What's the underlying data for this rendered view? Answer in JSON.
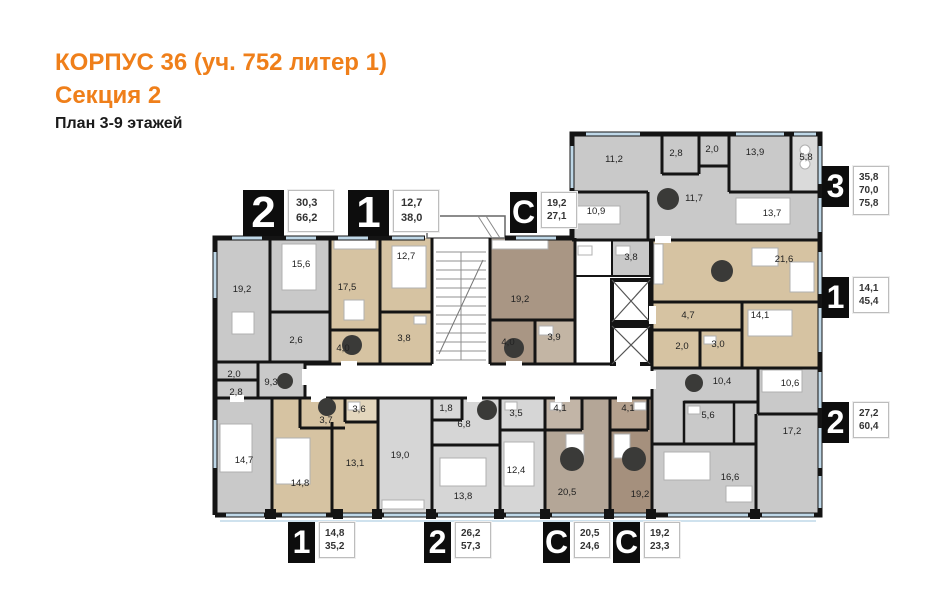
{
  "header": {
    "building_title": "КОРПУС 36 (уч. 752 литер 1)",
    "section_title": "Секция 2",
    "floors_subtitle": "План 3-9 этажей"
  },
  "colors": {
    "accent": "#ef7f1a",
    "wall": "#141414",
    "apartment_gray": "#c9c9c9",
    "apartment_gray_light": "#d6d6d6",
    "apartment_tan": "#d6c3a2",
    "studio_top_brown": "#a99684",
    "studio_light_brown": "#b4a697",
    "studio_dark_brown": "#a5907d",
    "window_glazing": "#bfd8e8",
    "entry_marker": "#3a3a38"
  },
  "plan": {
    "apartment_tags": [
      {
        "number": "2",
        "values": [
          "30,3",
          "66,2"
        ],
        "x": 243,
        "y": 190,
        "size": "large"
      },
      {
        "number": "1",
        "values": [
          "12,7",
          "38,0"
        ],
        "x": 348,
        "y": 190,
        "size": "large"
      },
      {
        "number": "С",
        "values": [
          "19,2",
          "27,1"
        ],
        "x": 510,
        "y": 192,
        "size": "small"
      },
      {
        "number": "3",
        "values": [
          "35,8",
          "70,0",
          "75,8"
        ],
        "x": 822,
        "y": 166,
        "size": "small"
      },
      {
        "number": "1",
        "values": [
          "14,1",
          "45,4"
        ],
        "x": 822,
        "y": 277,
        "size": "small"
      },
      {
        "number": "2",
        "values": [
          "27,2",
          "60,4"
        ],
        "x": 822,
        "y": 402,
        "size": "small"
      },
      {
        "number": "1",
        "values": [
          "14,8",
          "35,2"
        ],
        "x": 288,
        "y": 522,
        "size": "small"
      },
      {
        "number": "2",
        "values": [
          "26,2",
          "57,3"
        ],
        "x": 424,
        "y": 522,
        "size": "small"
      },
      {
        "number": "С",
        "values": [
          "20,5",
          "24,6"
        ],
        "x": 543,
        "y": 522,
        "size": "small"
      },
      {
        "number": "С",
        "values": [
          "19,2",
          "23,3"
        ],
        "x": 613,
        "y": 522,
        "size": "small"
      }
    ],
    "rooms": [
      {
        "area": "19,2",
        "x": 242,
        "y": 292
      },
      {
        "area": "15,6",
        "x": 301,
        "y": 267
      },
      {
        "area": "2,6",
        "x": 296,
        "y": 343
      },
      {
        "area": "2,0",
        "x": 234,
        "y": 377
      },
      {
        "area": "2,8",
        "x": 236,
        "y": 395
      },
      {
        "area": "9,3",
        "x": 271,
        "y": 385
      },
      {
        "area": "14,7",
        "x": 244,
        "y": 463
      },
      {
        "area": "17,5",
        "x": 347,
        "y": 290
      },
      {
        "area": "12,7",
        "x": 406,
        "y": 259
      },
      {
        "area": "4,0",
        "x": 343,
        "y": 351
      },
      {
        "area": "3,8",
        "x": 404,
        "y": 341
      },
      {
        "area": "19,2",
        "x": 520,
        "y": 302
      },
      {
        "area": "4,0",
        "x": 508,
        "y": 345
      },
      {
        "area": "3,9",
        "x": 554,
        "y": 340
      },
      {
        "area": "11,2",
        "x": 614,
        "y": 162
      },
      {
        "area": "2,8",
        "x": 676,
        "y": 156
      },
      {
        "area": "2,0",
        "x": 712,
        "y": 152
      },
      {
        "area": "13,9",
        "x": 755,
        "y": 155
      },
      {
        "area": "5,8",
        "x": 806,
        "y": 160
      },
      {
        "area": "10,9",
        "x": 596,
        "y": 214
      },
      {
        "area": "11,7",
        "x": 694,
        "y": 201
      },
      {
        "area": "13,7",
        "x": 772,
        "y": 216
      },
      {
        "area": "3,8",
        "x": 631,
        "y": 260
      },
      {
        "area": "21,6",
        "x": 784,
        "y": 262
      },
      {
        "area": "4,7",
        "x": 688,
        "y": 318
      },
      {
        "area": "2,0",
        "x": 682,
        "y": 349
      },
      {
        "area": "3,0",
        "x": 718,
        "y": 347
      },
      {
        "area": "14,1",
        "x": 760,
        "y": 318
      },
      {
        "area": "10,4",
        "x": 722,
        "y": 384
      },
      {
        "area": "10,6",
        "x": 790,
        "y": 386
      },
      {
        "area": "5,6",
        "x": 708,
        "y": 418
      },
      {
        "area": "17,2",
        "x": 792,
        "y": 434
      },
      {
        "area": "16,6",
        "x": 730,
        "y": 480
      },
      {
        "area": "3,7",
        "x": 326,
        "y": 423
      },
      {
        "area": "3,6",
        "x": 359,
        "y": 412
      },
      {
        "area": "14,8",
        "x": 300,
        "y": 486
      },
      {
        "area": "13,1",
        "x": 355,
        "y": 466
      },
      {
        "area": "19,0",
        "x": 400,
        "y": 458
      },
      {
        "area": "1,8",
        "x": 446,
        "y": 411
      },
      {
        "area": "6,8",
        "x": 464,
        "y": 427
      },
      {
        "area": "3,5",
        "x": 516,
        "y": 416
      },
      {
        "area": "13,8",
        "x": 463,
        "y": 499
      },
      {
        "area": "12,4",
        "x": 516,
        "y": 473
      },
      {
        "area": "4,1",
        "x": 560,
        "y": 411
      },
      {
        "area": "20,5",
        "x": 567,
        "y": 495
      },
      {
        "area": "4,1",
        "x": 628,
        "y": 411
      },
      {
        "area": "19,2",
        "x": 640,
        "y": 497
      }
    ],
    "entry_markers": [
      {
        "x": 285,
        "y": 381,
        "r": 8
      },
      {
        "x": 352,
        "y": 345,
        "r": 10
      },
      {
        "x": 514,
        "y": 348,
        "r": 10
      },
      {
        "x": 668,
        "y": 199,
        "r": 11
      },
      {
        "x": 722,
        "y": 271,
        "r": 11
      },
      {
        "x": 694,
        "y": 383,
        "r": 9
      },
      {
        "x": 327,
        "y": 407,
        "r": 9
      },
      {
        "x": 487,
        "y": 410,
        "r": 10
      },
      {
        "x": 572,
        "y": 459,
        "r": 12
      },
      {
        "x": 634,
        "y": 459,
        "r": 12
      }
    ]
  }
}
